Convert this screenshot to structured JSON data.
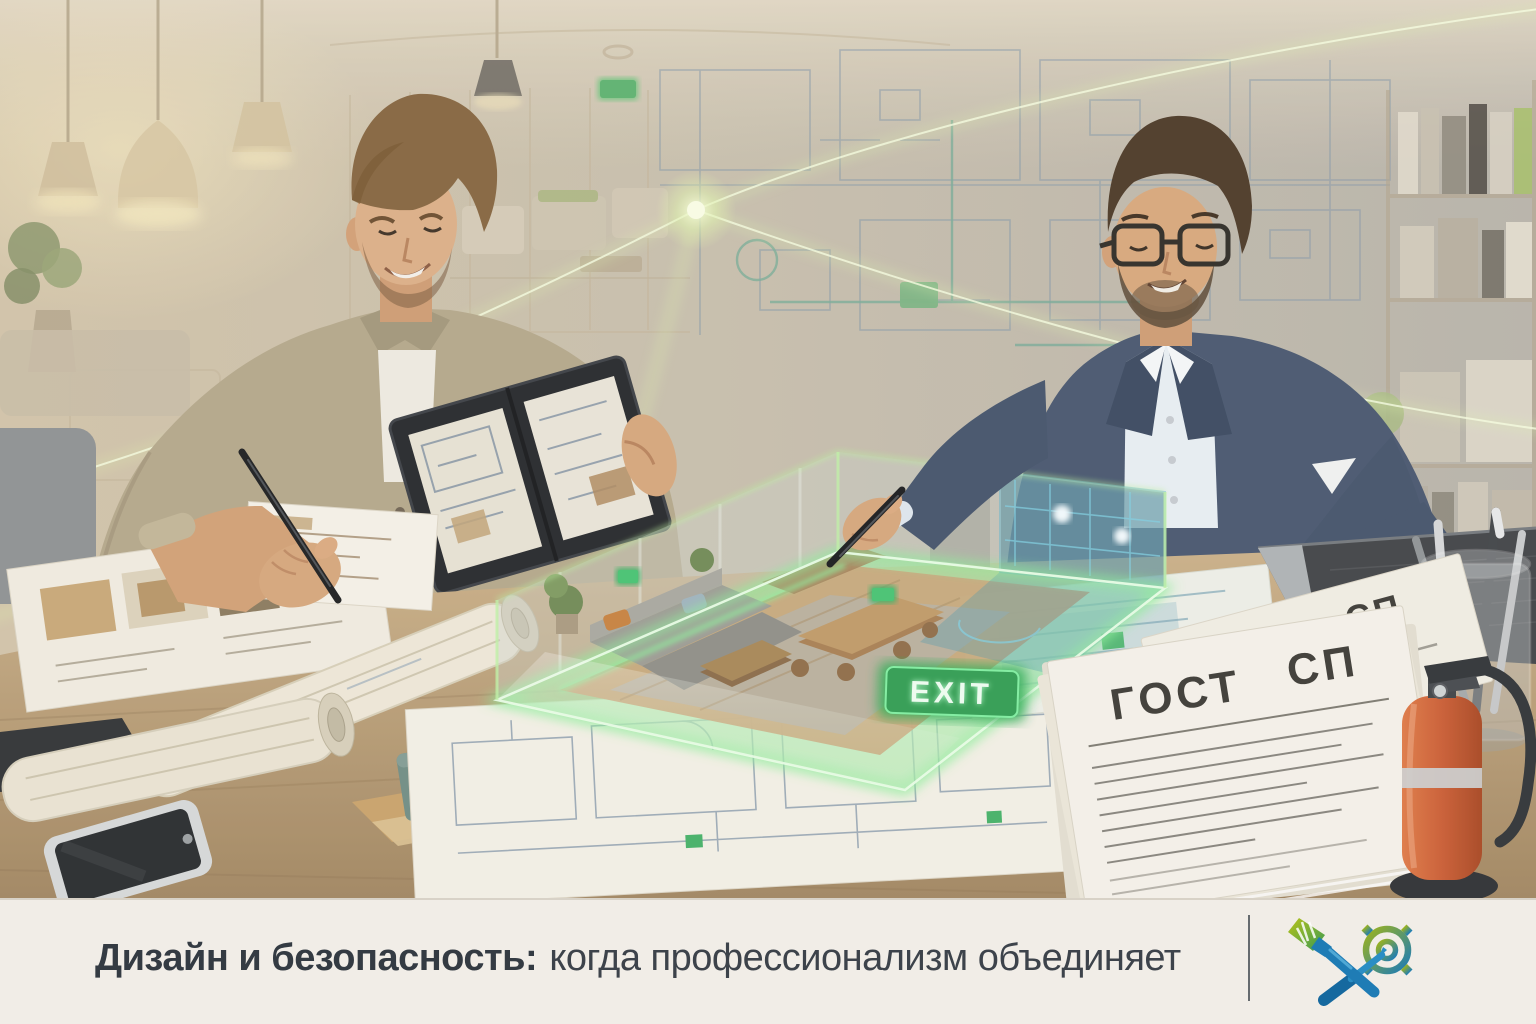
{
  "caption": {
    "title_bold": "Дизайн и безопасность:",
    "title_regular": "когда профессионализм объединяет"
  },
  "hologram": {
    "exit_label": "EXIT"
  },
  "documents": {
    "front": {
      "gost": "ГОСТ",
      "sp": "СП"
    },
    "back": {
      "gost": "ГОСТ",
      "sp": "СП"
    }
  },
  "branding": {
    "icons": [
      "paintbrush-icon",
      "gear-icon",
      "screwdriver-icon"
    ],
    "logo_gradient_start": "#9db31d",
    "logo_gradient_end": "#1d7cb7"
  },
  "colors": {
    "caption_bar_bg": "#f1ede7",
    "caption_text": "#3b4149",
    "hologram_glow": "#8df09b",
    "exit_sign_green": "#2f9e52",
    "suit_navy": "#46566f",
    "shirt_beige": "#b4a88b",
    "table_wood": "#c0a87e",
    "extinguisher_orange": "#cb5c33",
    "blueprint_line": "#8398aa"
  }
}
